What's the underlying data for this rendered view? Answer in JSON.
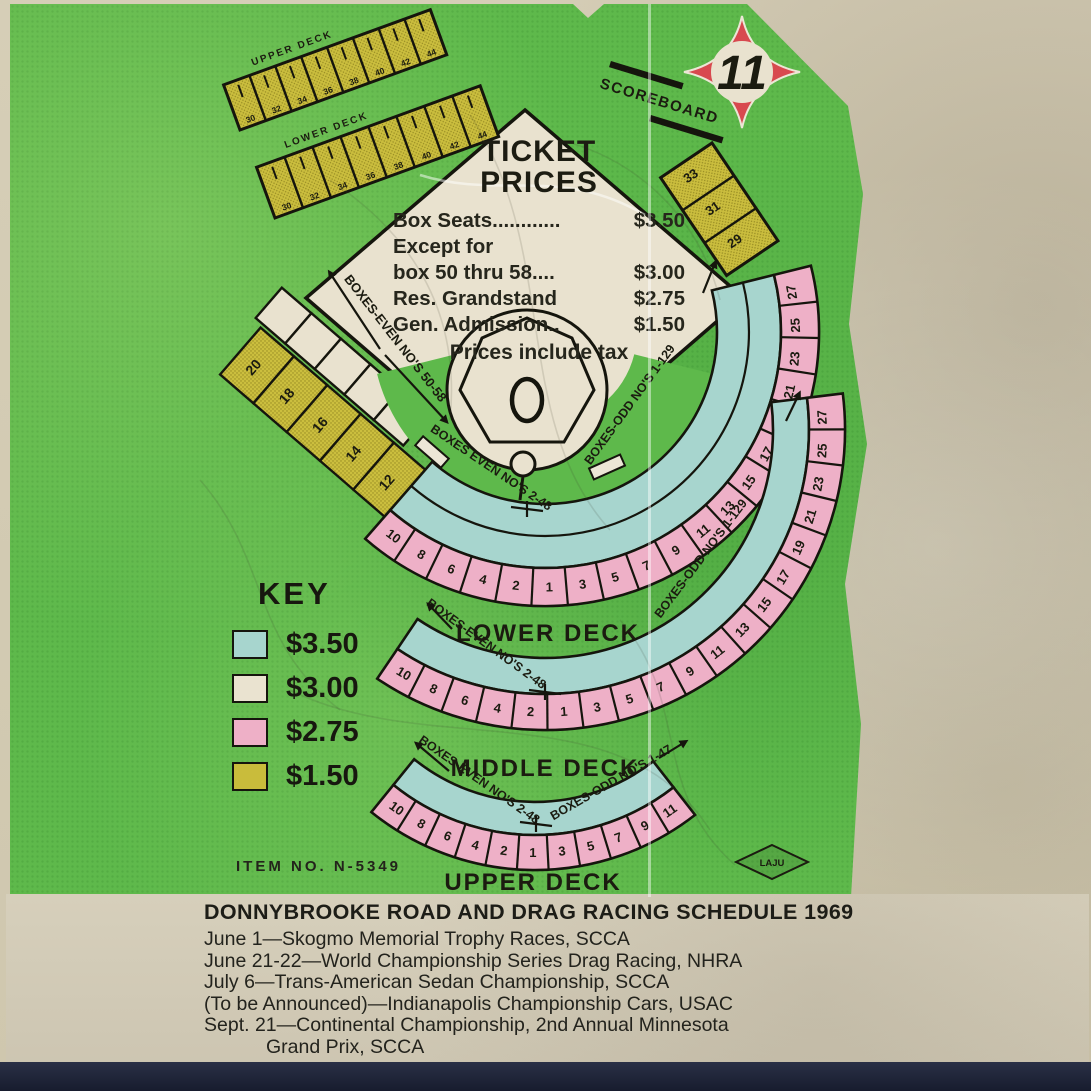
{
  "card": {
    "page_number": "11",
    "scoreboard_label": "SCOREBOARD",
    "item_no": "ITEM NO. N-5349",
    "union_label": "LAJU"
  },
  "ticket_prices": {
    "title_line1": "TICKET",
    "title_line2": "PRICES",
    "rows": [
      {
        "label": "Box Seats............",
        "price": "$3.50"
      },
      {
        "label": "Except for",
        "price": ""
      },
      {
        "label": "box 50 thru 58....",
        "price": "$3.00"
      },
      {
        "label": "Res. Grandstand",
        "price": "$2.75"
      },
      {
        "label": "Gen. Admission..",
        "price": "$1.50"
      }
    ],
    "footnote": "Prices include tax"
  },
  "key": {
    "title": "KEY",
    "entries": [
      {
        "color": "#a7d5ce",
        "price": "$3.50"
      },
      {
        "color": "#eae3d0",
        "price": "$3.00"
      },
      {
        "color": "#eeb0c7",
        "price": "$2.75"
      },
      {
        "color": "#c9bc3b",
        "price": "$1.50"
      }
    ]
  },
  "map": {
    "decks": [
      {
        "caption": "LOWER DECK",
        "left_label": "BOXES EVEN NO'S 2-48",
        "right_label": "BOXES-ODD NO'S 1-129",
        "sections": [
          "10",
          "8",
          "6",
          "4",
          "2",
          "1",
          "3",
          "5",
          "7",
          "9",
          "11",
          "13",
          "15",
          "17",
          "19",
          "21",
          "23",
          "25",
          "27"
        ]
      },
      {
        "caption": "MIDDLE DECK",
        "left_label": "BOXES-EVEN NO'S 2-48",
        "right_label": "BOXES-ODD NO'S 1-129",
        "sections": [
          "10",
          "8",
          "6",
          "4",
          "2",
          "1",
          "3",
          "5",
          "7",
          "9",
          "11",
          "13",
          "15",
          "17",
          "19",
          "21",
          "23",
          "25",
          "27"
        ]
      },
      {
        "caption": "UPPER DECK",
        "left_label": "BOXES-EVEN NO'S 2-48",
        "right_label": "BOXES-ODD NO'S 1-47",
        "sections": [
          "10",
          "8",
          "6",
          "4",
          "2",
          "1",
          "3",
          "5",
          "7",
          "9",
          "11"
        ]
      }
    ],
    "third_base_label": "BOXES-EVEN NO'S 50-58",
    "left_field_sections": [
      "20",
      "18",
      "16",
      "14",
      "12"
    ],
    "right_field_sections": [
      "33",
      "31",
      "29"
    ],
    "bleachers": {
      "upper_label": "UPPER DECK",
      "lower_label": "LOWER DECK",
      "upper_sections": [
        "30",
        "32",
        "34",
        "36",
        "38",
        "40",
        "42",
        "44"
      ],
      "lower_sections": [
        "30",
        "32",
        "34",
        "36",
        "38",
        "40",
        "42",
        "44"
      ]
    }
  },
  "schedule": {
    "title": "DONNYBROOKE ROAD AND DRAG RACING SCHEDULE 1969",
    "lines": [
      "June 1—Skogmo Memorial Trophy Races, SCCA",
      "June 21-22—World Championship Series Drag Racing, NHRA",
      "July 6—Trans-American Sedan Championship, SCCA",
      "(To be Announced)—Indianapolis Championship Cars, USAC",
      "Sept. 21—Continental Championship, 2nd Annual Minnesota",
      "Grand Prix, SCCA"
    ]
  }
}
